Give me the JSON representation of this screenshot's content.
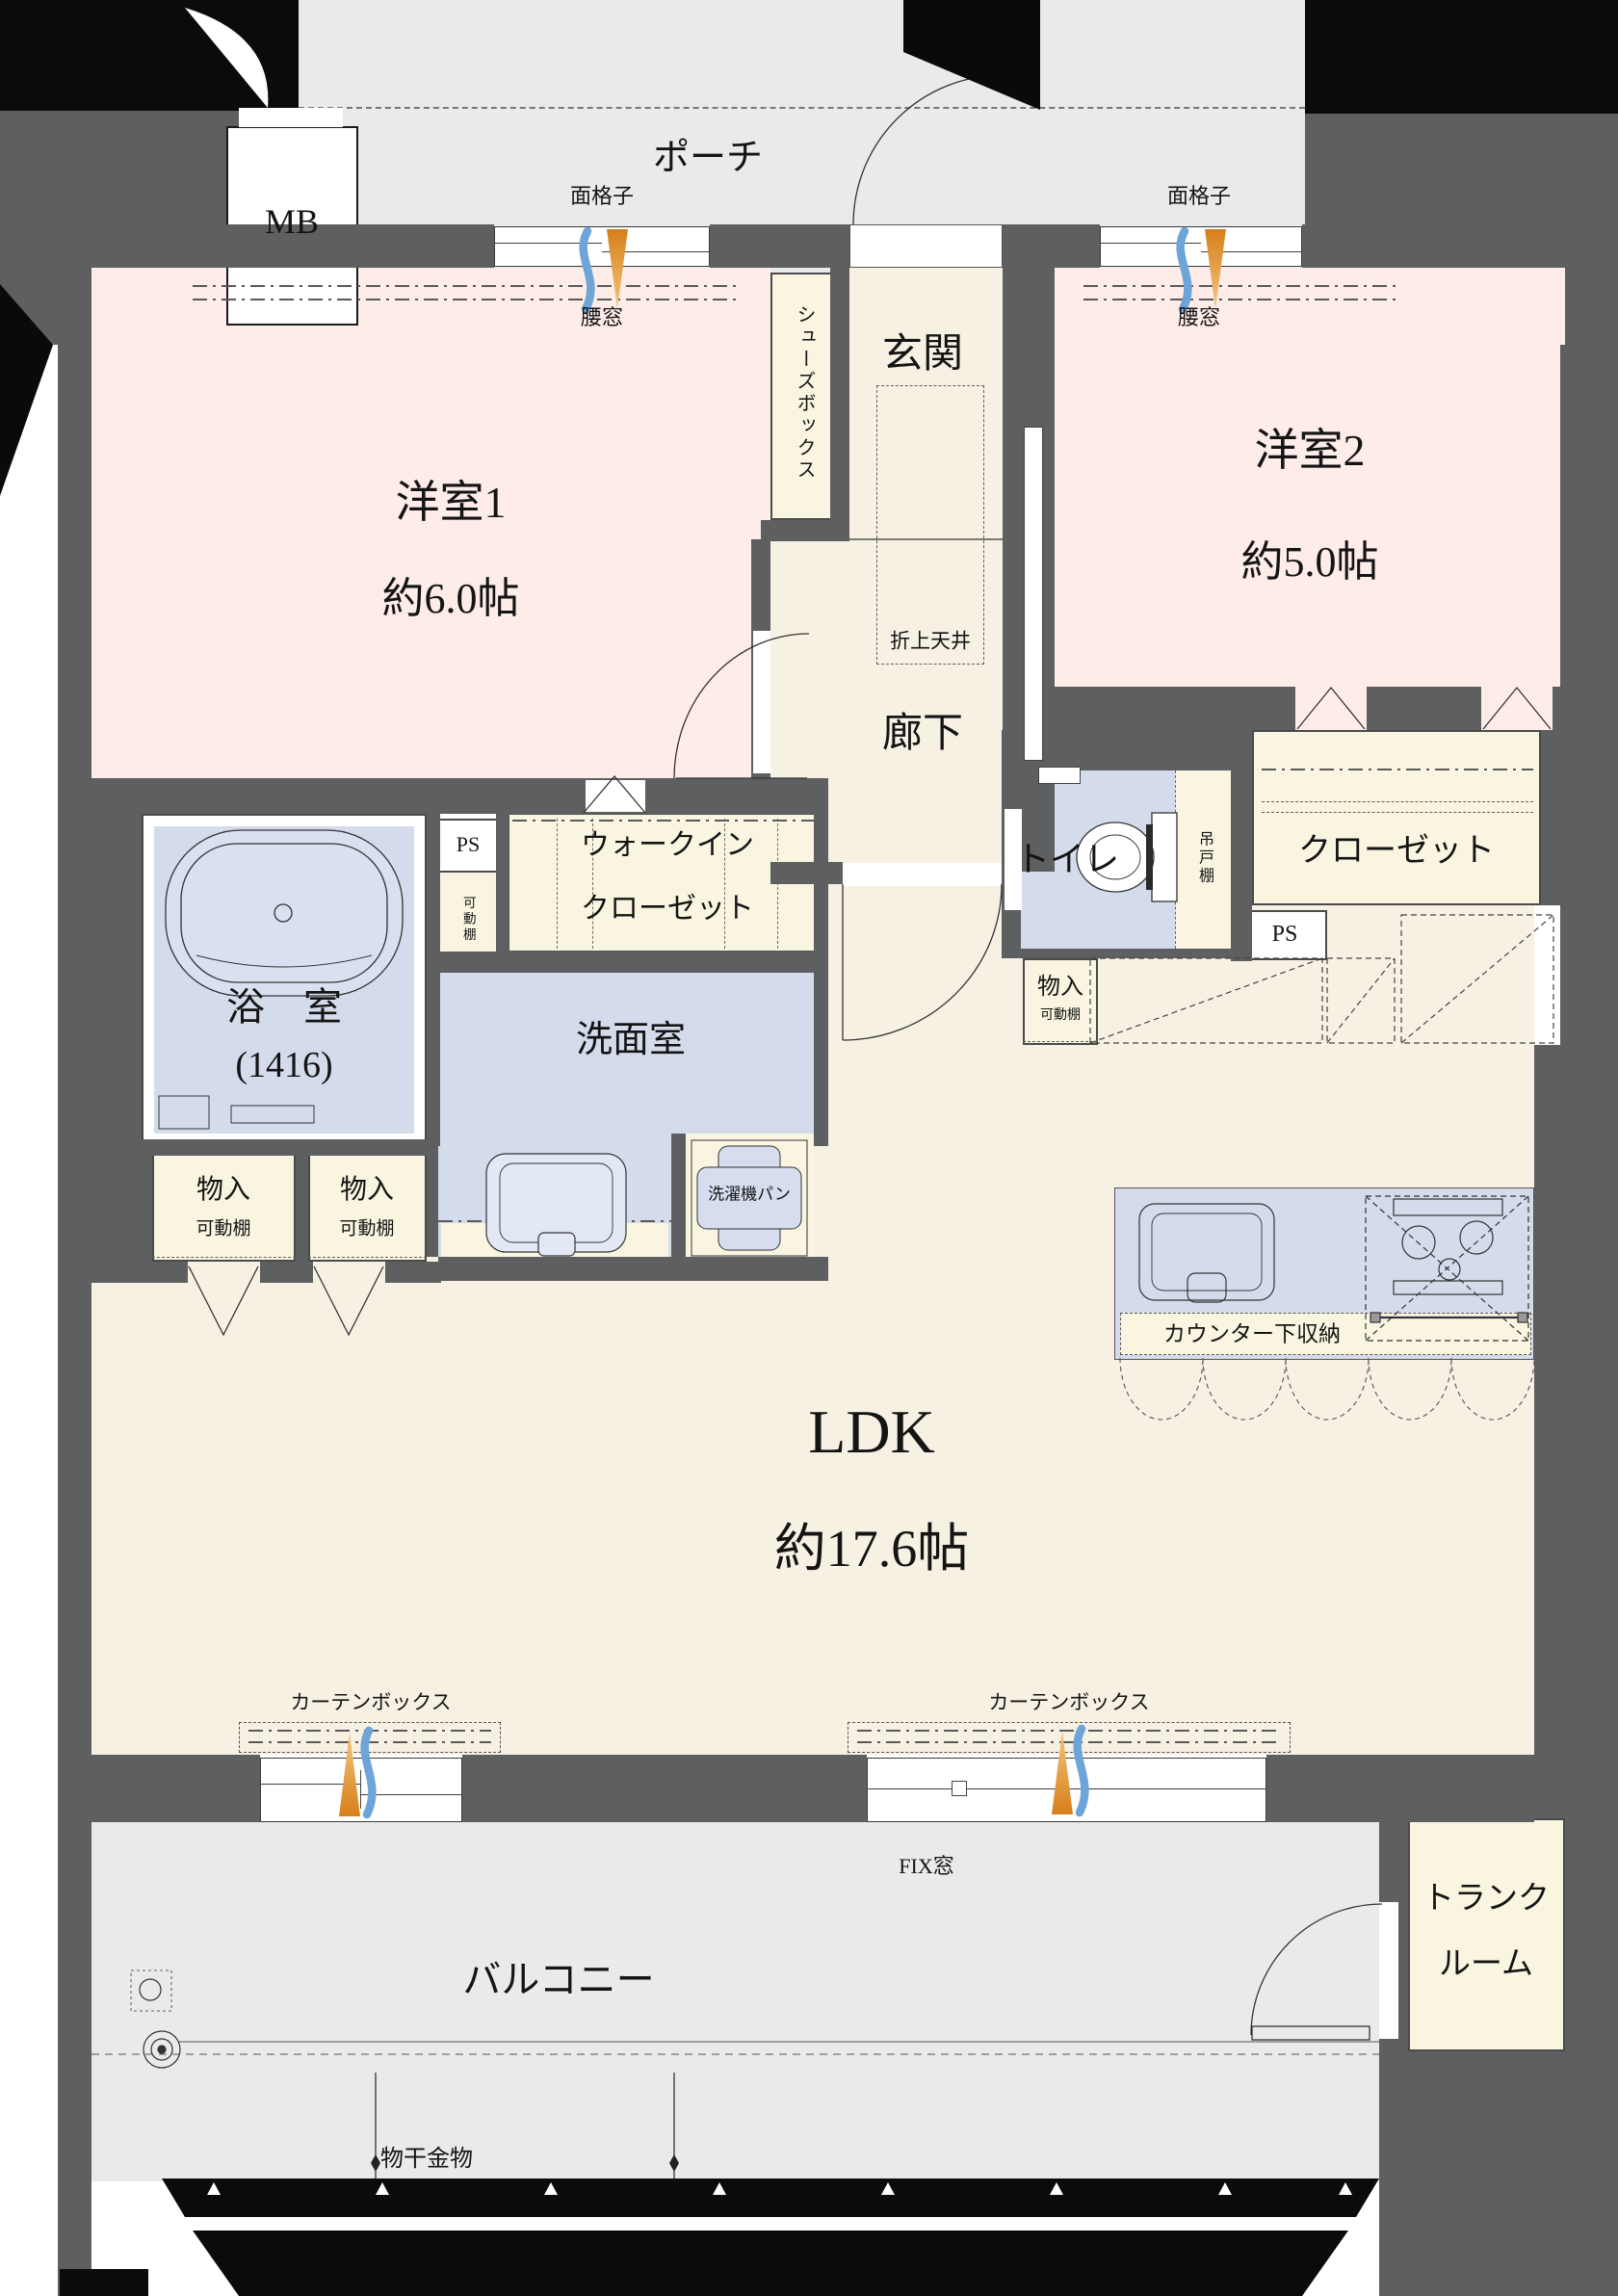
{
  "colors": {
    "wall": "#5e5f60",
    "ink": "#0b0b0b",
    "porch": "#e8eaeb",
    "pink": "#fdece8",
    "cream": "#f7f1e4",
    "cream2": "#f9f5e0",
    "blue": "#d4dcec",
    "wave": "#6da5d8",
    "cone": "#dd8f35"
  },
  "rooms": {
    "mb": "MB",
    "porch": "ポーチ",
    "entrance": "玄関",
    "corridor": "廊下",
    "shoes_box": "シューズボックス",
    "room1": {
      "name": "洋室1",
      "size": "約6.0帖"
    },
    "room2": {
      "name": "洋室2",
      "size": "約5.0帖"
    },
    "wic": {
      "line1": "ウォークイン",
      "line2": "クローゼット"
    },
    "closet": "クローゼット",
    "toilet": "トイレ",
    "hanging_cupboard": "吊戸棚",
    "bath": {
      "name": "浴　室",
      "size": "(1416)"
    },
    "washroom": "洗面室",
    "laundry_pan": "洗濯機パン",
    "ldk": {
      "name": "LDK",
      "size": "約17.6帖"
    },
    "counter_storage": "カウンター下収納",
    "balcony": "バルコニー",
    "trunk": {
      "line1": "トランク",
      "line2": "ルーム"
    },
    "ps": "PS",
    "storage": "物入",
    "shelf": "可動棚"
  },
  "annotations": {
    "grille": "面格子",
    "waist_window": "腰窓",
    "coffered_ceiling": "折上天井",
    "curtain_box": "カーテンボックス",
    "fix_window": "FIX窓",
    "laundry_hardware": "物干金物"
  }
}
